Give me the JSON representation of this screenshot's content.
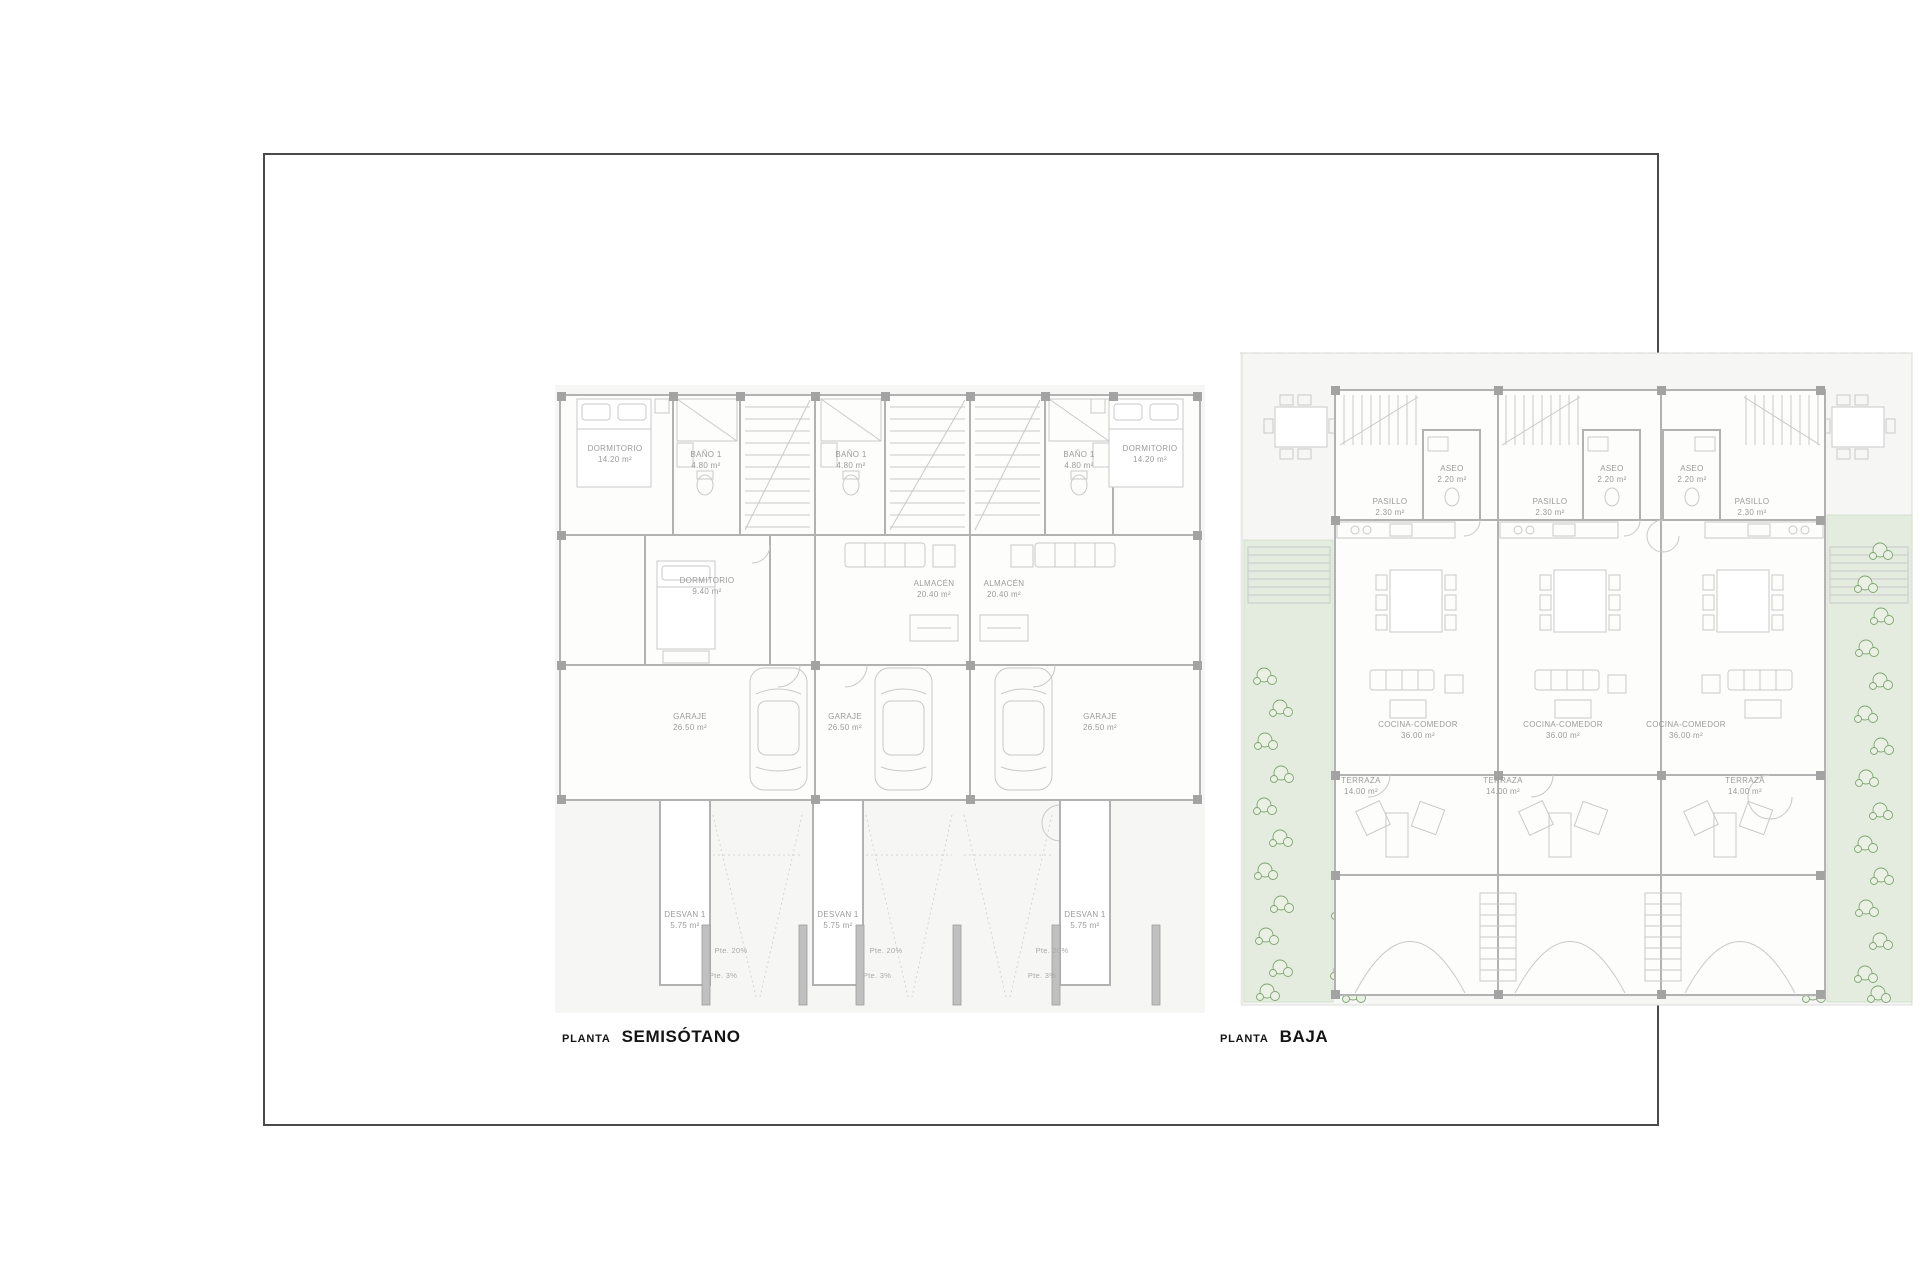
{
  "sheet": {
    "border_color": "#4a4a4a",
    "background": "#ffffff"
  },
  "colors": {
    "wall_line": "#b2b2b2",
    "thin_line": "#c9c9c9",
    "label_text": "#9b9b9b",
    "title_text": "#141414",
    "garden_fill": "#e4ecdf",
    "plant_green": "#7fa571"
  },
  "plans": [
    {
      "key": "semisotano",
      "title_prefix": "PLANTA",
      "title_name": "SEMISÓTANO",
      "labels": [
        {
          "text": "DORMITORIO",
          "area": "14.20 m²",
          "x": 60,
          "y": 70
        },
        {
          "text": "BAÑO 1",
          "area": "4.80 m²",
          "x": 151,
          "y": 76
        },
        {
          "text": "BAÑO 1",
          "area": "4.80 m²",
          "x": 296,
          "y": 76
        },
        {
          "text": "BAÑO 1",
          "area": "4.80 m²",
          "x": 524,
          "y": 76
        },
        {
          "text": "DORMITORIO",
          "area": "14.20 m²",
          "x": 595,
          "y": 70
        },
        {
          "text": "DORMITORIO",
          "area": "9.40 m²",
          "x": 152,
          "y": 202
        },
        {
          "text": "ALMACÉN",
          "area": "20.40 m²",
          "x": 379,
          "y": 205
        },
        {
          "text": "ALMACÉN",
          "area": "20.40 m²",
          "x": 449,
          "y": 205
        },
        {
          "text": "GARAJE",
          "area": "26.50 m²",
          "x": 135,
          "y": 338
        },
        {
          "text": "GARAJE",
          "area": "26.50 m²",
          "x": 290,
          "y": 338
        },
        {
          "text": "GARAJE",
          "area": "26.50 m²",
          "x": 545,
          "y": 338
        },
        {
          "text": "DESVAN 1",
          "area": "5.75 m²",
          "x": 130,
          "y": 536
        },
        {
          "text": "DESVAN 1",
          "area": "5.75 m²",
          "x": 283,
          "y": 536
        },
        {
          "text": "DESVAN 1",
          "area": "5.75 m²",
          "x": 530,
          "y": 536
        },
        {
          "text": "Pte. 20%",
          "x": 176,
          "y": 566,
          "small": true
        },
        {
          "text": "Pte. 20%",
          "x": 331,
          "y": 566,
          "small": true
        },
        {
          "text": "Pte. 20%",
          "x": 497,
          "y": 566,
          "small": true
        },
        {
          "text": "Pte. 3%",
          "x": 168,
          "y": 591,
          "small": true
        },
        {
          "text": "Pte. 3%",
          "x": 322,
          "y": 591,
          "small": true
        },
        {
          "text": "Pte. 3%",
          "x": 487,
          "y": 591,
          "small": true
        }
      ]
    },
    {
      "key": "baja",
      "title_prefix": "PLANTA",
      "title_name": "BAJA",
      "labels": [
        {
          "text": "ASEO",
          "area": "2.20 m²",
          "x": 212,
          "y": 130
        },
        {
          "text": "ASEO",
          "area": "2.20 m²",
          "x": 372,
          "y": 130
        },
        {
          "text": "ASEO",
          "area": "2.20 m²",
          "x": 452,
          "y": 130
        },
        {
          "text": "PASILLO",
          "area": "2.30 m²",
          "x": 150,
          "y": 163
        },
        {
          "text": "PASILLO",
          "area": "2.30 m²",
          "x": 310,
          "y": 163
        },
        {
          "text": "PASILLO",
          "area": "2.30 m²",
          "x": 512,
          "y": 163
        },
        {
          "text": "COCINA-COMEDOR",
          "area": "36.00 m²",
          "x": 178,
          "y": 386
        },
        {
          "text": "COCINA-COMEDOR",
          "area": "36.00 m²",
          "x": 323,
          "y": 386
        },
        {
          "text": "COCINA-COMEDOR",
          "area": "36.00 m²",
          "x": 446,
          "y": 386
        },
        {
          "text": "TERRAZA",
          "area": "14.00 m²",
          "x": 121,
          "y": 442
        },
        {
          "text": "TERRAZA",
          "area": "14.00 m²",
          "x": 263,
          "y": 442
        },
        {
          "text": "TERRAZA",
          "area": "14.00 m²",
          "x": 505,
          "y": 442
        }
      ]
    }
  ]
}
